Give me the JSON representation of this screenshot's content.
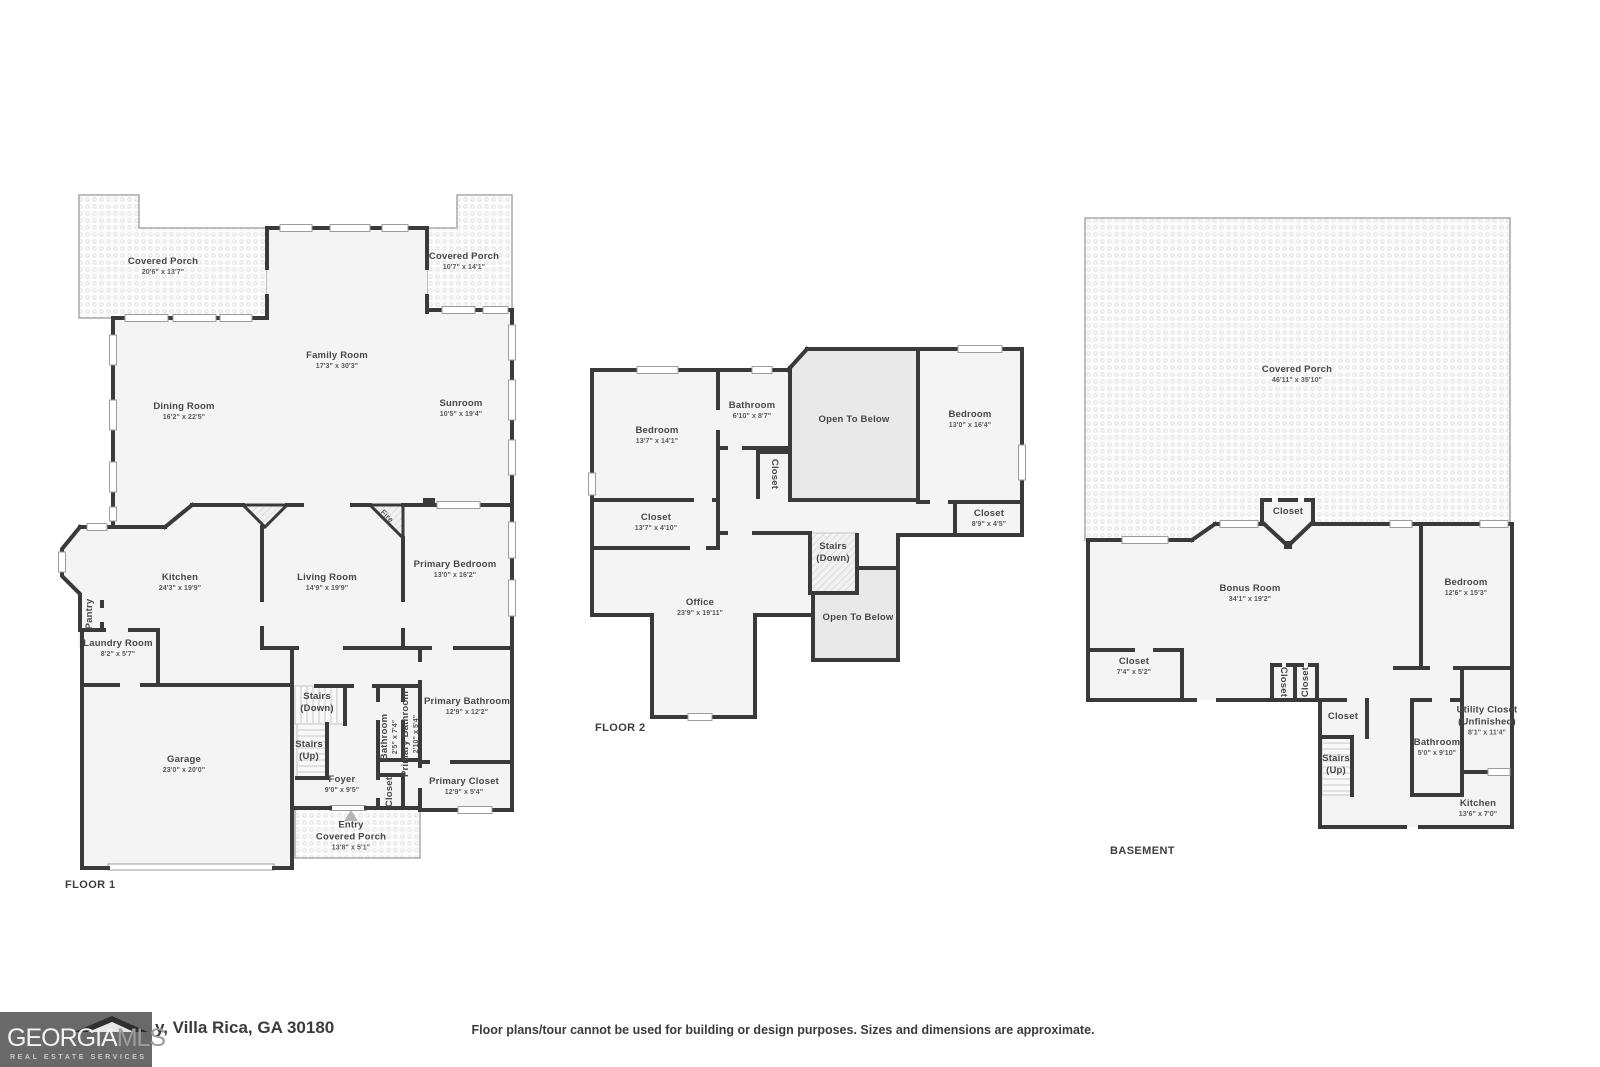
{
  "floor1": {
    "title": "FLOOR 1",
    "rooms": {
      "porch_left": {
        "name": "Covered Porch",
        "dims": "20'6\" x 13'7\""
      },
      "porch_right": {
        "name": "Covered Porch",
        "dims": "10'7\" x 14'1\""
      },
      "family_room": {
        "name": "Family Room",
        "dims": "17'3\" x 30'3\""
      },
      "dining_room": {
        "name": "Dining Room",
        "dims": "16'2\" x 22'5\""
      },
      "sunroom": {
        "name": "Sunroom",
        "dims": "10'5\" x 19'4\""
      },
      "kitchen": {
        "name": "Kitchen",
        "dims": "24'3\" x 19'9\""
      },
      "living_room": {
        "name": "Living Room",
        "dims": "14'9\" x 19'9\""
      },
      "primary_bedroom": {
        "name": "Primary Bedroom",
        "dims": "13'0\" x 16'2\""
      },
      "pantry": {
        "name": "Pantry"
      },
      "laundry_room": {
        "name": "Laundry Room",
        "dims": "8'2\" x 5'7\""
      },
      "stairs_down": {
        "name": "Stairs",
        "sub": "(Down)"
      },
      "stairs_up": {
        "name": "Stairs",
        "sub": "(Up)"
      },
      "garage": {
        "name": "Garage",
        "dims": "23'0\" x 20'0\""
      },
      "foyer": {
        "name": "Foyer",
        "dims": "9'0\" x 9'5\""
      },
      "bathroom": {
        "name": "Bathroom",
        "dims": "2'5\" x 7'4\""
      },
      "primary_bathroom_small": {
        "name": "Primary Bathroom",
        "dims": "2'10\" x 5'4\""
      },
      "closet": {
        "name": "Closet"
      },
      "primary_bathroom": {
        "name": "Primary Bathroom",
        "dims": "12'9\" x 12'2\""
      },
      "primary_closet": {
        "name": "Primary Closet",
        "dims": "12'9\" x 5'4\""
      },
      "entry_porch": {
        "name": "Entry",
        "sub": "Covered Porch",
        "dims": "13'8\" x 5'1\""
      },
      "fireplace": {
        "name": "Fire"
      }
    }
  },
  "floor2": {
    "title": "FLOOR 2",
    "rooms": {
      "bedroom_left": {
        "name": "Bedroom",
        "dims": "13'7\" x 14'1\""
      },
      "bathroom": {
        "name": "Bathroom",
        "dims": "6'10\" x 8'7\""
      },
      "open_to_below_upper": {
        "name": "Open To Below"
      },
      "bedroom_right": {
        "name": "Bedroom",
        "dims": "13'0\" x 16'4\""
      },
      "closet_hall": {
        "name": "Closet"
      },
      "closet_left": {
        "name": "Closet",
        "dims": "13'7\" x 4'10\""
      },
      "closet_right": {
        "name": "Closet",
        "dims": "8'9\" x 4'5\""
      },
      "stairs_down": {
        "name": "Stairs",
        "sub": "(Down)"
      },
      "office": {
        "name": "Office",
        "dims": "23'9\" x 19'11\""
      },
      "open_to_below_lower": {
        "name": "Open To Below"
      }
    }
  },
  "basement": {
    "title": "BASEMENT",
    "rooms": {
      "covered_porch": {
        "name": "Covered Porch",
        "dims": "46'11\" x 35'10\""
      },
      "closet_bay": {
        "name": "Closet"
      },
      "bonus_room": {
        "name": "Bonus Room",
        "dims": "34'1\" x 19'2\""
      },
      "bedroom": {
        "name": "Bedroom",
        "dims": "12'6\" x 15'3\""
      },
      "closet_left": {
        "name": "Closet",
        "dims": "7'4\" x 5'2\""
      },
      "closet_a": {
        "name": "Closet"
      },
      "closet_b": {
        "name": "Closet"
      },
      "closet_hall": {
        "name": "Closet"
      },
      "stairs_up": {
        "name": "Stairs",
        "sub": "(Up)"
      },
      "bathroom": {
        "name": "Bathroom",
        "dims": "5'0\" x 9'10\""
      },
      "utility_closet": {
        "name": "Utility Closet",
        "sub": "(Unfinished)",
        "dims": "8'1\" x 11'4\""
      },
      "kitchen": {
        "name": "Kitchen",
        "dims": "13'6\" x 7'0\""
      }
    }
  },
  "footer": {
    "logo_word1": "GEORGIA",
    "logo_word2": "MLS",
    "logo_sub": "REAL ESTATE SERVICES",
    "address": "y, Villa Rica, GA 30180",
    "disclaimer": "Floor plans/tour cannot be used for building or design purposes. Sizes and dimensions are approximate."
  },
  "colors": {
    "wall": "#3a3a3a",
    "room_fill": "#f4f4f4",
    "open_below_fill": "#e9e9e9",
    "porch_border": "#a9a9a9",
    "logo_bg": "#696969"
  }
}
